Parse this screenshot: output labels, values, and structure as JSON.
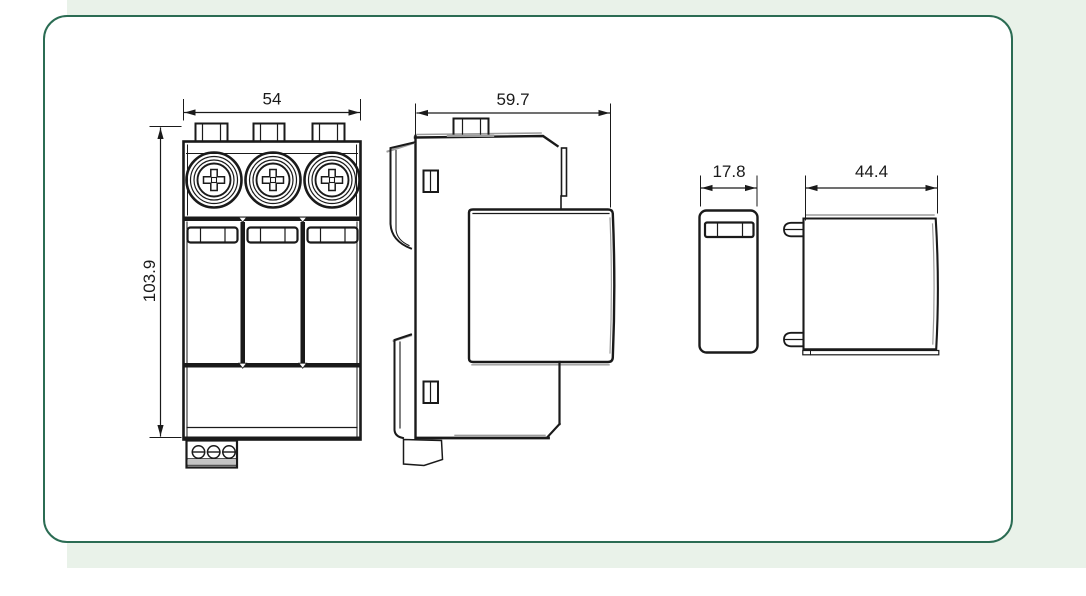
{
  "page": {
    "background_color": "#ffffff",
    "accent_panel_color": "#e9f2e9",
    "card": {
      "background_color": "#ffffff",
      "border_color": "#2b6c53"
    }
  },
  "drawing": {
    "type": "dimensioned-technical-drawing",
    "stroke_color": "#1a1a1a",
    "shade_color": "#9c9c9c",
    "views": [
      {
        "name": "front-view"
      },
      {
        "name": "side-view"
      },
      {
        "name": "plug-module-front-view"
      },
      {
        "name": "plug-module-side-view"
      }
    ],
    "dimension_labels": {
      "front_width": "54",
      "front_height": "103.9",
      "side_depth": "59.7",
      "module_width": "17.8",
      "module_depth": "44.4"
    }
  }
}
